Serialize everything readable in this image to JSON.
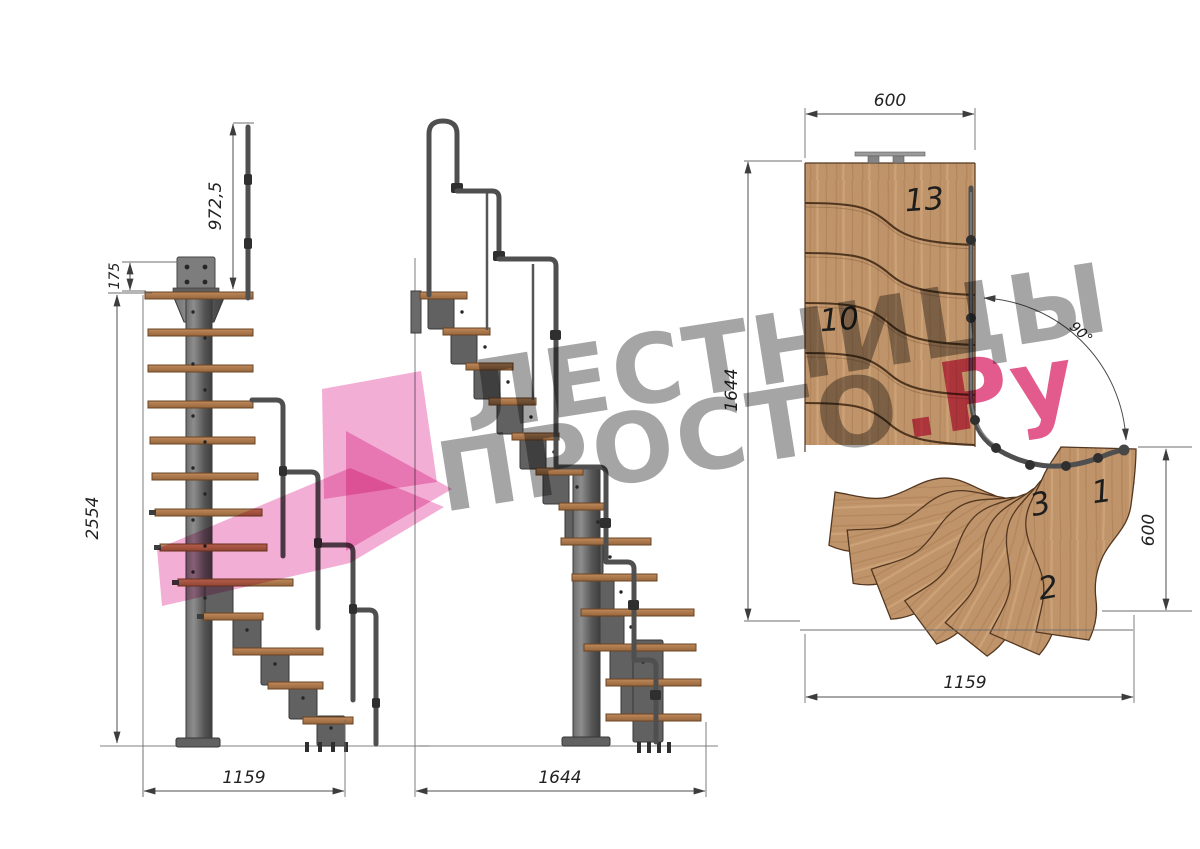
{
  "title": "Modular staircase technical drawing",
  "watermark": {
    "line1": "ЛЕСТНИЦЫ",
    "line2": "ПРОСТО",
    "suffix": ".Ру",
    "text_color": "#a5a5a5",
    "accent_color": "#e0457e",
    "logo_color": "#f3aed6"
  },
  "side_view": {
    "dim_post_height": "972,5",
    "dim_plate": "175",
    "dim_total_height": "2554",
    "dim_width": "1159"
  },
  "front_view": {
    "dim_width": "1644"
  },
  "plan_view": {
    "dim_top_width": "600",
    "dim_left_height": "1644",
    "dim_angle": "90°",
    "dim_right_height": "600",
    "dim_bottom_width": "1159",
    "labels": {
      "step13": "13",
      "step10": "10",
      "step3": "3",
      "step1": "1",
      "step2": "2"
    }
  },
  "colors": {
    "wood": "#c0946a",
    "metal": "#5a5a5a",
    "dimension_lines": "#4d4d4d"
  }
}
